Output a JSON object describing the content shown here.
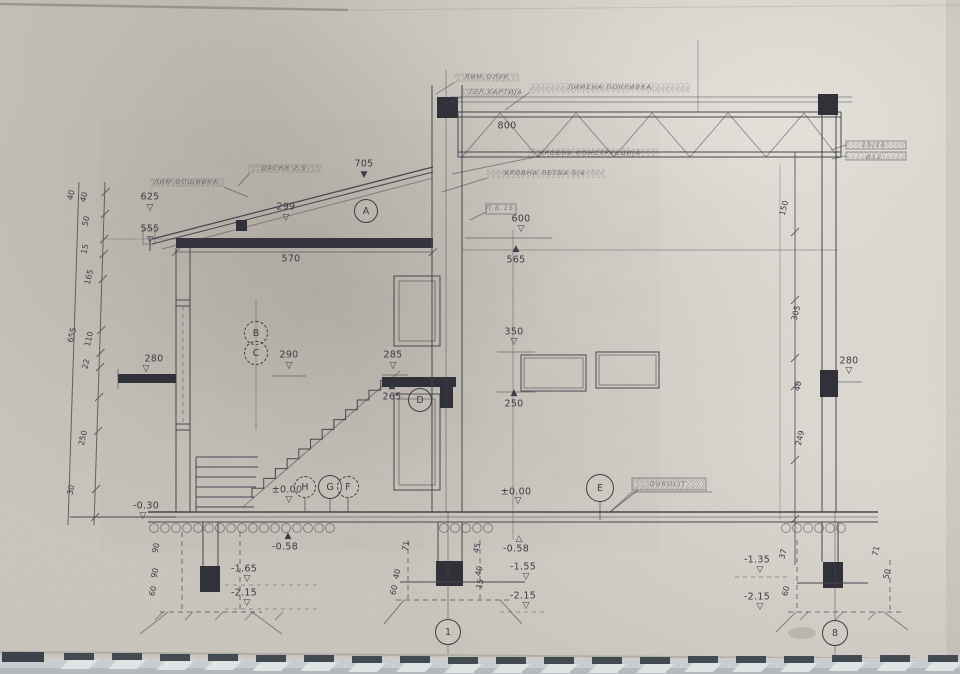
{
  "meta": {
    "document_type": "architectural cross-section drawing (scanned photo)",
    "sheet_bottom_grid_axes": [
      "1",
      "8"
    ]
  },
  "colors": {
    "paper": "#ccc7bf",
    "ink": "#44444e",
    "dark_fill": "#31313a",
    "strip_dash": "#424a52",
    "strip_band": "#c9cdd0"
  },
  "drawing": {
    "section_marks": [
      "A",
      "B",
      "C",
      "D",
      "E",
      "F",
      "G",
      "H"
    ],
    "grid_bubbles": [
      "1",
      "8"
    ],
    "levels": [
      "625",
      "555",
      "705",
      "600",
      "565",
      "350",
      "290",
      "285",
      "265",
      "250",
      "280",
      "±0.00",
      "-0.30",
      "-0.58",
      "-1.35",
      "-1.55",
      "-1.65",
      "-2.15"
    ],
    "spans": [
      "570",
      "800",
      "299"
    ]
  },
  "bubbles": [
    {
      "t": "A",
      "x": 366,
      "y": 211,
      "d": 22,
      "n": "section-mark-a"
    },
    {
      "t": "B",
      "x": 256,
      "y": 333,
      "d": 22,
      "dash": true,
      "n": "section-mark-b"
    },
    {
      "t": "C",
      "x": 256,
      "y": 353,
      "d": 22,
      "dash": true,
      "n": "section-mark-c"
    },
    {
      "t": "D",
      "x": 420,
      "y": 400,
      "d": 22,
      "n": "section-mark-d"
    },
    {
      "t": "E",
      "x": 600,
      "y": 488,
      "d": 26,
      "n": "section-mark-e"
    },
    {
      "t": "H",
      "x": 305,
      "y": 487,
      "d": 20,
      "dash": true,
      "n": "section-mark-h"
    },
    {
      "t": "G",
      "x": 330,
      "y": 487,
      "d": 22,
      "n": "section-mark-g"
    },
    {
      "t": "F",
      "x": 348,
      "y": 487,
      "d": 20,
      "dash": true,
      "n": "section-mark-f"
    },
    {
      "t": "1",
      "x": 448,
      "y": 632,
      "d": 24,
      "n": "grid-bubble-1"
    },
    {
      "t": "8",
      "x": 835,
      "y": 633,
      "d": 24,
      "n": "grid-bubble-8"
    }
  ],
  "labels": [
    {
      "t": "625",
      "x": 150,
      "y": 197,
      "n": "level-625"
    },
    {
      "t": "555",
      "x": 150,
      "y": 229,
      "n": "level-555"
    },
    {
      "t": "299",
      "x": 286,
      "y": 207,
      "n": "dim-299"
    },
    {
      "t": "705",
      "x": 364,
      "y": 164,
      "n": "level-705"
    },
    {
      "t": "570",
      "x": 291,
      "y": 259,
      "n": "dim-570"
    },
    {
      "t": "800",
      "x": 507,
      "y": 126,
      "n": "dim-800"
    },
    {
      "t": "600",
      "x": 521,
      "y": 219,
      "n": "level-600"
    },
    {
      "t": "565",
      "x": 516,
      "y": 260,
      "n": "level-565"
    },
    {
      "t": "280",
      "x": 154,
      "y": 359,
      "n": "level-280-left"
    },
    {
      "t": "290",
      "x": 289,
      "y": 355,
      "n": "level-290"
    },
    {
      "t": "285",
      "x": 393,
      "y": 355,
      "n": "level-285"
    },
    {
      "t": "265",
      "x": 392,
      "y": 397,
      "n": "level-265"
    },
    {
      "t": "350",
      "x": 514,
      "y": 332,
      "n": "level-350"
    },
    {
      "t": "250",
      "x": 514,
      "y": 404,
      "n": "level-250"
    },
    {
      "t": "±0.00",
      "x": 287,
      "y": 490,
      "n": "level-pm000-left"
    },
    {
      "t": "-0.58",
      "x": 285,
      "y": 547,
      "n": "level-m058-left"
    },
    {
      "t": "±0.00",
      "x": 516,
      "y": 492,
      "n": "level-pm000-center"
    },
    {
      "t": "-0.58",
      "x": 516,
      "y": 549,
      "n": "level-m058-center"
    },
    {
      "t": "-0.30",
      "x": 146,
      "y": 506,
      "n": "level-m030"
    },
    {
      "t": "-1.65",
      "x": 244,
      "y": 569,
      "n": "level-m165"
    },
    {
      "t": "-2.15",
      "x": 244,
      "y": 593,
      "n": "level-m215-left"
    },
    {
      "t": "-1.55",
      "x": 523,
      "y": 567,
      "n": "level-m155"
    },
    {
      "t": "-2.15",
      "x": 523,
      "y": 596,
      "n": "level-m215-center"
    },
    {
      "t": "-1.35",
      "x": 757,
      "y": 560,
      "n": "level-m135"
    },
    {
      "t": "-2.15",
      "x": 757,
      "y": 597,
      "n": "level-m215-right"
    },
    {
      "t": "280",
      "x": 849,
      "y": 361,
      "n": "level-280-right"
    },
    {
      "t": "▽",
      "x": 150,
      "y": 208,
      "c": "mk",
      "n": "level-marker"
    },
    {
      "t": "▽",
      "x": 150,
      "y": 240,
      "c": "mk",
      "n": "level-marker"
    },
    {
      "t": "▽",
      "x": 286,
      "y": 218,
      "c": "mk",
      "n": "level-marker"
    },
    {
      "t": "▼",
      "x": 364,
      "y": 175,
      "c": "mkf",
      "n": "level-marker"
    },
    {
      "t": "▽",
      "x": 521,
      "y": 229,
      "c": "mk",
      "n": "level-marker"
    },
    {
      "t": "▲",
      "x": 516,
      "y": 249,
      "c": "mkf",
      "n": "level-marker"
    },
    {
      "t": "▽",
      "x": 514,
      "y": 342,
      "c": "mk",
      "n": "level-marker"
    },
    {
      "t": "▲",
      "x": 514,
      "y": 393,
      "c": "mkf",
      "n": "level-marker"
    },
    {
      "t": "▽",
      "x": 289,
      "y": 366,
      "c": "mk",
      "n": "level-marker"
    },
    {
      "t": "▽",
      "x": 393,
      "y": 366,
      "c": "mk",
      "n": "level-marker"
    },
    {
      "t": "▲",
      "x": 392,
      "y": 386,
      "c": "mkf",
      "n": "level-marker"
    },
    {
      "t": "▽",
      "x": 146,
      "y": 369,
      "c": "mk",
      "n": "level-marker"
    },
    {
      "t": "▽",
      "x": 289,
      "y": 500,
      "c": "mk",
      "n": "level-marker"
    },
    {
      "t": "▲",
      "x": 288,
      "y": 536,
      "c": "mkf",
      "n": "level-marker"
    },
    {
      "t": "▽",
      "x": 518,
      "y": 501,
      "c": "mk",
      "n": "level-marker"
    },
    {
      "t": "△",
      "x": 519,
      "y": 539,
      "c": "mk",
      "n": "level-marker"
    },
    {
      "t": "▽",
      "x": 143,
      "y": 516,
      "c": "mk",
      "n": "level-marker"
    },
    {
      "t": "▽",
      "x": 247,
      "y": 579,
      "c": "mk",
      "n": "level-marker"
    },
    {
      "t": "▽",
      "x": 247,
      "y": 603,
      "c": "mk",
      "n": "level-marker"
    },
    {
      "t": "▽",
      "x": 526,
      "y": 577,
      "c": "mk",
      "n": "level-marker"
    },
    {
      "t": "▽",
      "x": 526,
      "y": 606,
      "c": "mk",
      "n": "level-marker"
    },
    {
      "t": "▽",
      "x": 760,
      "y": 570,
      "c": "mk",
      "n": "level-marker"
    },
    {
      "t": "▽",
      "x": 760,
      "y": 607,
      "c": "mk",
      "n": "level-marker"
    },
    {
      "t": "▽",
      "x": 849,
      "y": 371,
      "c": "mk",
      "n": "level-marker"
    },
    {
      "t": "40",
      "x": 71,
      "y": 195,
      "c": "dimr",
      "r": -76,
      "n": "chain-dim"
    },
    {
      "t": "40",
      "x": 84,
      "y": 197,
      "c": "dimr",
      "r": -76,
      "n": "chain-dim"
    },
    {
      "t": "50",
      "x": 86,
      "y": 221,
      "c": "dimr",
      "r": -76,
      "n": "chain-dim"
    },
    {
      "t": "15",
      "x": 85,
      "y": 249,
      "c": "dimr",
      "r": -76,
      "n": "chain-dim"
    },
    {
      "t": "165",
      "x": 89,
      "y": 277,
      "c": "dimr",
      "r": -76,
      "n": "chain-dim"
    },
    {
      "t": "655",
      "x": 72,
      "y": 335,
      "c": "dimr",
      "r": -76,
      "n": "chain-dim"
    },
    {
      "t": "110",
      "x": 89,
      "y": 339,
      "c": "dimr",
      "r": -76,
      "n": "chain-dim"
    },
    {
      "t": "22",
      "x": 86,
      "y": 364,
      "c": "dimr",
      "r": -76,
      "n": "chain-dim"
    },
    {
      "t": "250",
      "x": 83,
      "y": 438,
      "c": "dimr",
      "r": -76,
      "n": "chain-dim"
    },
    {
      "t": "30",
      "x": 71,
      "y": 490,
      "c": "dimr",
      "r": -76,
      "n": "chain-dim"
    },
    {
      "t": "150",
      "x": 784,
      "y": 208,
      "c": "dimr",
      "r": -76,
      "n": "chain-dim"
    },
    {
      "t": "305",
      "x": 796,
      "y": 313,
      "c": "dimr",
      "r": -76,
      "n": "chain-dim"
    },
    {
      "t": "40",
      "x": 798,
      "y": 386,
      "c": "dimr",
      "r": -76,
      "n": "chain-dim"
    },
    {
      "t": "249",
      "x": 800,
      "y": 438,
      "c": "dimr",
      "r": -76,
      "n": "chain-dim"
    },
    {
      "t": "90",
      "x": 156,
      "y": 548,
      "c": "dimr",
      "r": -76,
      "n": "footing-dim"
    },
    {
      "t": "90",
      "x": 155,
      "y": 573,
      "c": "dimr",
      "r": -76,
      "n": "footing-dim"
    },
    {
      "t": "60",
      "x": 153,
      "y": 591,
      "c": "dimr",
      "r": -76,
      "n": "footing-dim"
    },
    {
      "t": "71",
      "x": 406,
      "y": 546,
      "c": "dimr",
      "r": -76,
      "n": "footing-dim"
    },
    {
      "t": "40",
      "x": 397,
      "y": 574,
      "c": "dimr",
      "r": -76,
      "n": "footing-dim"
    },
    {
      "t": "60",
      "x": 394,
      "y": 590,
      "c": "dimr",
      "r": -76,
      "n": "footing-dim"
    },
    {
      "t": "45",
      "x": 477,
      "y": 548,
      "c": "dimr",
      "r": -76,
      "n": "footing-dim"
    },
    {
      "t": "40",
      "x": 479,
      "y": 571,
      "c": "dimr",
      "r": -76,
      "n": "footing-dim"
    },
    {
      "t": "15",
      "x": 480,
      "y": 584,
      "c": "dimr",
      "r": -76,
      "n": "footing-dim"
    },
    {
      "t": "37",
      "x": 783,
      "y": 554,
      "c": "dimr",
      "r": -76,
      "n": "footing-dim"
    },
    {
      "t": "60",
      "x": 786,
      "y": 591,
      "c": "dimr",
      "r": -76,
      "n": "footing-dim"
    },
    {
      "t": "71",
      "x": 876,
      "y": 551,
      "c": "dimr",
      "r": -76,
      "n": "footing-dim"
    },
    {
      "t": "50",
      "x": 887,
      "y": 574,
      "c": "dimr",
      "r": -76,
      "n": "footing-dim"
    },
    {
      "t": "ЛИМ.ОПШИВКА",
      "x": 186,
      "y": 182,
      "c": "hand",
      "n": "note-flashing"
    },
    {
      "t": "ДАСКИ 2.5",
      "x": 284,
      "y": 168,
      "c": "hand",
      "n": "note-boards"
    },
    {
      "t": "ЛИМ.ОЛУК",
      "x": 487,
      "y": 77,
      "c": "hand",
      "n": "note-gutter"
    },
    {
      "t": "ТЕР.ХАРТИЈА",
      "x": 496,
      "y": 92,
      "c": "hand",
      "n": "note-tarpaper"
    },
    {
      "t": "ЛИМЕНА ПОКРИВКА",
      "x": 610,
      "y": 87,
      "c": "hand",
      "n": "note-sheet-roofing"
    },
    {
      "t": "КРОВНА КОНСТРУКЦИЈА",
      "x": 590,
      "y": 153,
      "c": "hand",
      "n": "note-roof-structure"
    },
    {
      "t": "КРОВНА ЛЕТВА 5/8",
      "x": 545,
      "y": 173,
      "c": "hand",
      "n": "note-roof-batten"
    },
    {
      "t": "П.Б.15",
      "x": 500,
      "y": 208,
      "c": "hand",
      "n": "note-pb15"
    },
    {
      "t": "DUROLIT",
      "x": 668,
      "y": 484,
      "c": "hand",
      "n": "note-durolit"
    },
    {
      "t": "15/15",
      "x": 874,
      "y": 145,
      "c": "hand",
      "n": "note-15-15"
    },
    {
      "t": "Ø12",
      "x": 874,
      "y": 157,
      "c": "hand",
      "n": "note-o12"
    }
  ]
}
